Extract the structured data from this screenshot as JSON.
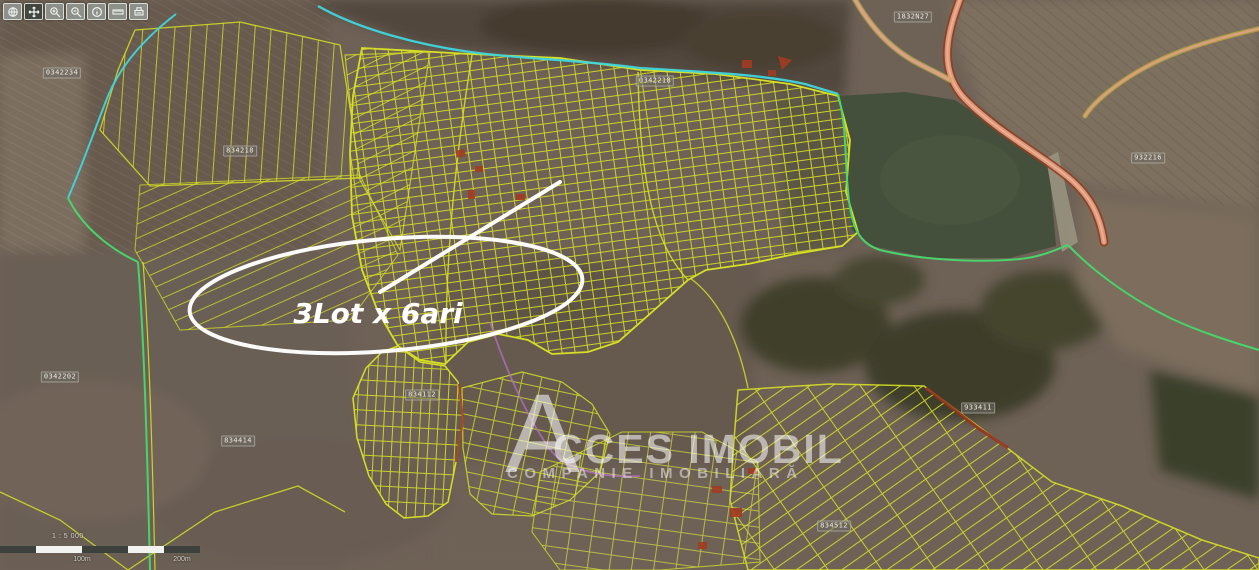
{
  "app": {
    "type": "cadastral-map-viewer"
  },
  "toolbar": {
    "buttons": [
      {
        "label": "overview",
        "icon": "globe-icon"
      },
      {
        "label": "pan",
        "icon": "pan-icon"
      },
      {
        "label": "zoom-in",
        "icon": "zoom-in-icon"
      },
      {
        "label": "zoom-out",
        "icon": "zoom-out-icon"
      },
      {
        "label": "identify",
        "icon": "info-icon"
      },
      {
        "label": "measure",
        "icon": "measure-icon"
      },
      {
        "label": "print",
        "icon": "print-icon"
      }
    ]
  },
  "annotation": {
    "label": "3Lot x 6ari"
  },
  "watermark": {
    "brand": "ACCES IMOBIL",
    "brand_initial": "A",
    "brand_rest": "CCES IMOBIL",
    "tagline": "COMPANIE IMOBILIARĂ"
  },
  "scalebar": {
    "ratio": "1 : 5 000",
    "labels": [
      "100m",
      "200m"
    ]
  },
  "parcel_labels": [
    {
      "text": "0342234"
    },
    {
      "text": "834218"
    },
    {
      "text": "0342218"
    },
    {
      "text": "1832N27"
    },
    {
      "text": "932216"
    },
    {
      "text": "933411"
    },
    {
      "text": "0342202"
    },
    {
      "text": "834414"
    },
    {
      "text": "834112"
    },
    {
      "text": "834512"
    }
  ],
  "colors": {
    "parcel_line": "#d6df25",
    "boundary_cyan": "#3fd6de",
    "boundary_green": "#49d36b",
    "road_fill": "#dd9677",
    "road_edge": "#8f3d20",
    "lake": "#45503c",
    "red_parcel": "#a33b22",
    "annotation": "#ffffff",
    "watermark": "#ffffff"
  }
}
